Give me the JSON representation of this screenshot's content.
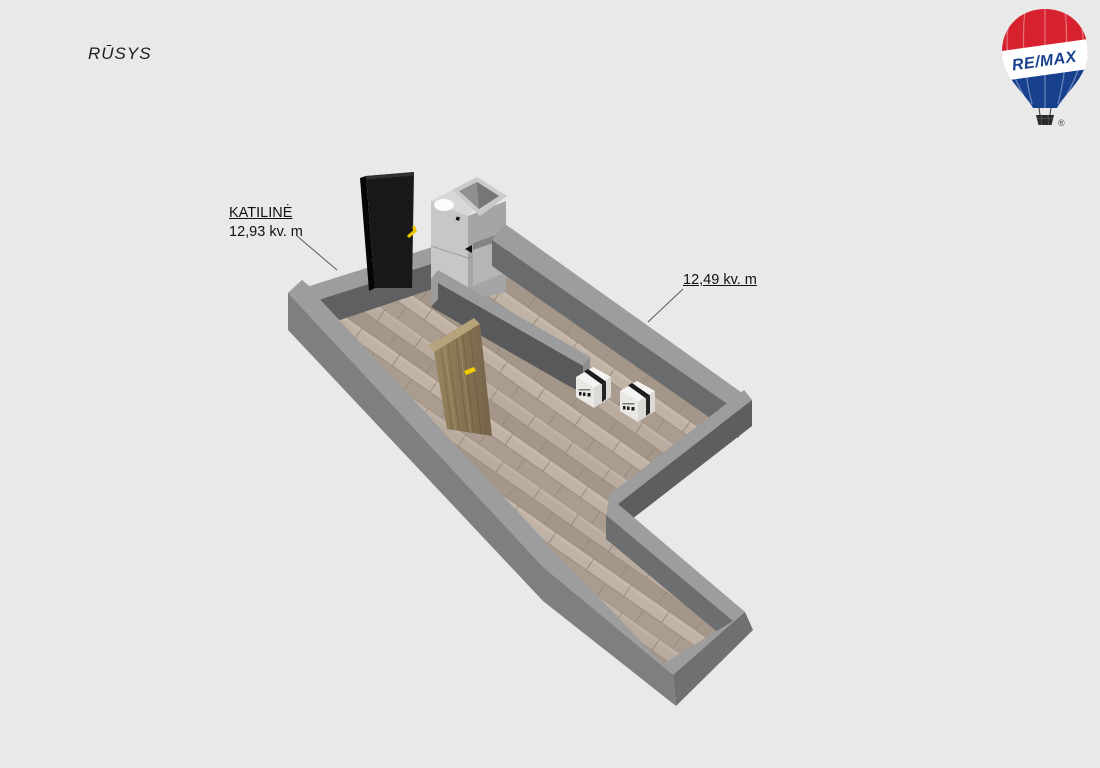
{
  "page": {
    "background_color": "#e9e9e9",
    "width": 1100,
    "height": 768
  },
  "header": {
    "title": "RŪSYS"
  },
  "logo": {
    "brand": "RE/MAX",
    "registered_mark": "®",
    "balloon_red": "#d8212f",
    "balloon_blue": "#17418f"
  },
  "floor_plan": {
    "rooms": [
      {
        "name": "KATILINĖ",
        "area_label": "12,93 kv. m"
      },
      {
        "name": "",
        "area_label": "12,49 kv. m"
      }
    ],
    "objects": [
      "entrance-door",
      "boiler-unit",
      "wooden-door",
      "moving-box",
      "moving-box"
    ],
    "colors": {
      "wall_top": "#9d9d9d",
      "wall_outer": "#7e7f80",
      "wall_inner_shadow": "#5f6061",
      "partition_shadow": "#58595a",
      "floor_light": "#b7aa9d",
      "floor_dark": "#a4978a",
      "door_wood": "#8b7a58",
      "handle_yellow": "#f2cc00"
    }
  }
}
